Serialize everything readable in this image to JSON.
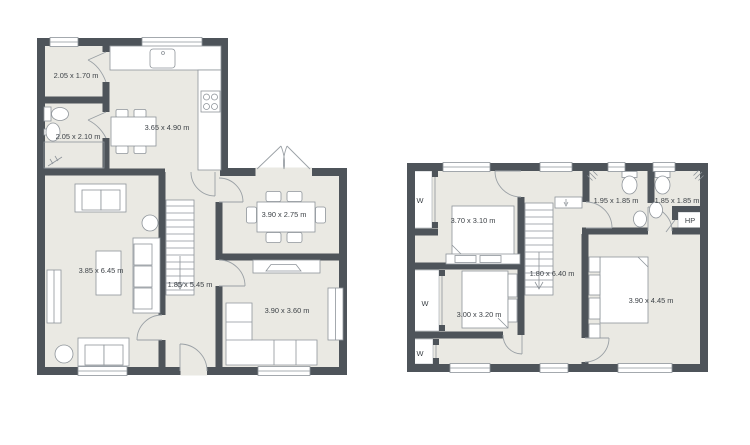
{
  "colors": {
    "wall": "#4e545a",
    "floor": "#eae9e3",
    "furniture_stroke": "#8e949a",
    "label_text": "#3d4247",
    "background": "#ffffff"
  },
  "plans": {
    "ground": {
      "name": "ground-floor",
      "rooms": {
        "storage": {
          "label": "2.05 x 1.70 m"
        },
        "wc": {
          "label": "2.05 x 2.10 m"
        },
        "kitchen": {
          "label": "3.65 x 4.90 m"
        },
        "dining": {
          "label": "3.90 x 2.75 m"
        },
        "living": {
          "label": "3.85 x 6.45 m"
        },
        "hallway": {
          "label": "1.85 x 5.45 m"
        },
        "tv_room": {
          "label": "3.90 x 3.60 m"
        }
      }
    },
    "upper": {
      "name": "upper-floor",
      "rooms": {
        "bedroom1": {
          "label": "3.70 x 3.10 m"
        },
        "bedroom2": {
          "label": "3.00 x 3.20 m"
        },
        "master_bedroom": {
          "label": "3.90 x 4.45 m"
        },
        "hallway": {
          "label": "1.80 x 6.40 m"
        },
        "bathroom1": {
          "label": "1.95 x 1.85 m"
        },
        "bathroom2": {
          "label": "1.85 x 1.85 m"
        },
        "heat_pump": {
          "label": "HP"
        },
        "wardrobe1": {
          "label": "W"
        },
        "wardrobe2": {
          "label": "W"
        },
        "wardrobe3": {
          "label": "W"
        }
      }
    }
  }
}
